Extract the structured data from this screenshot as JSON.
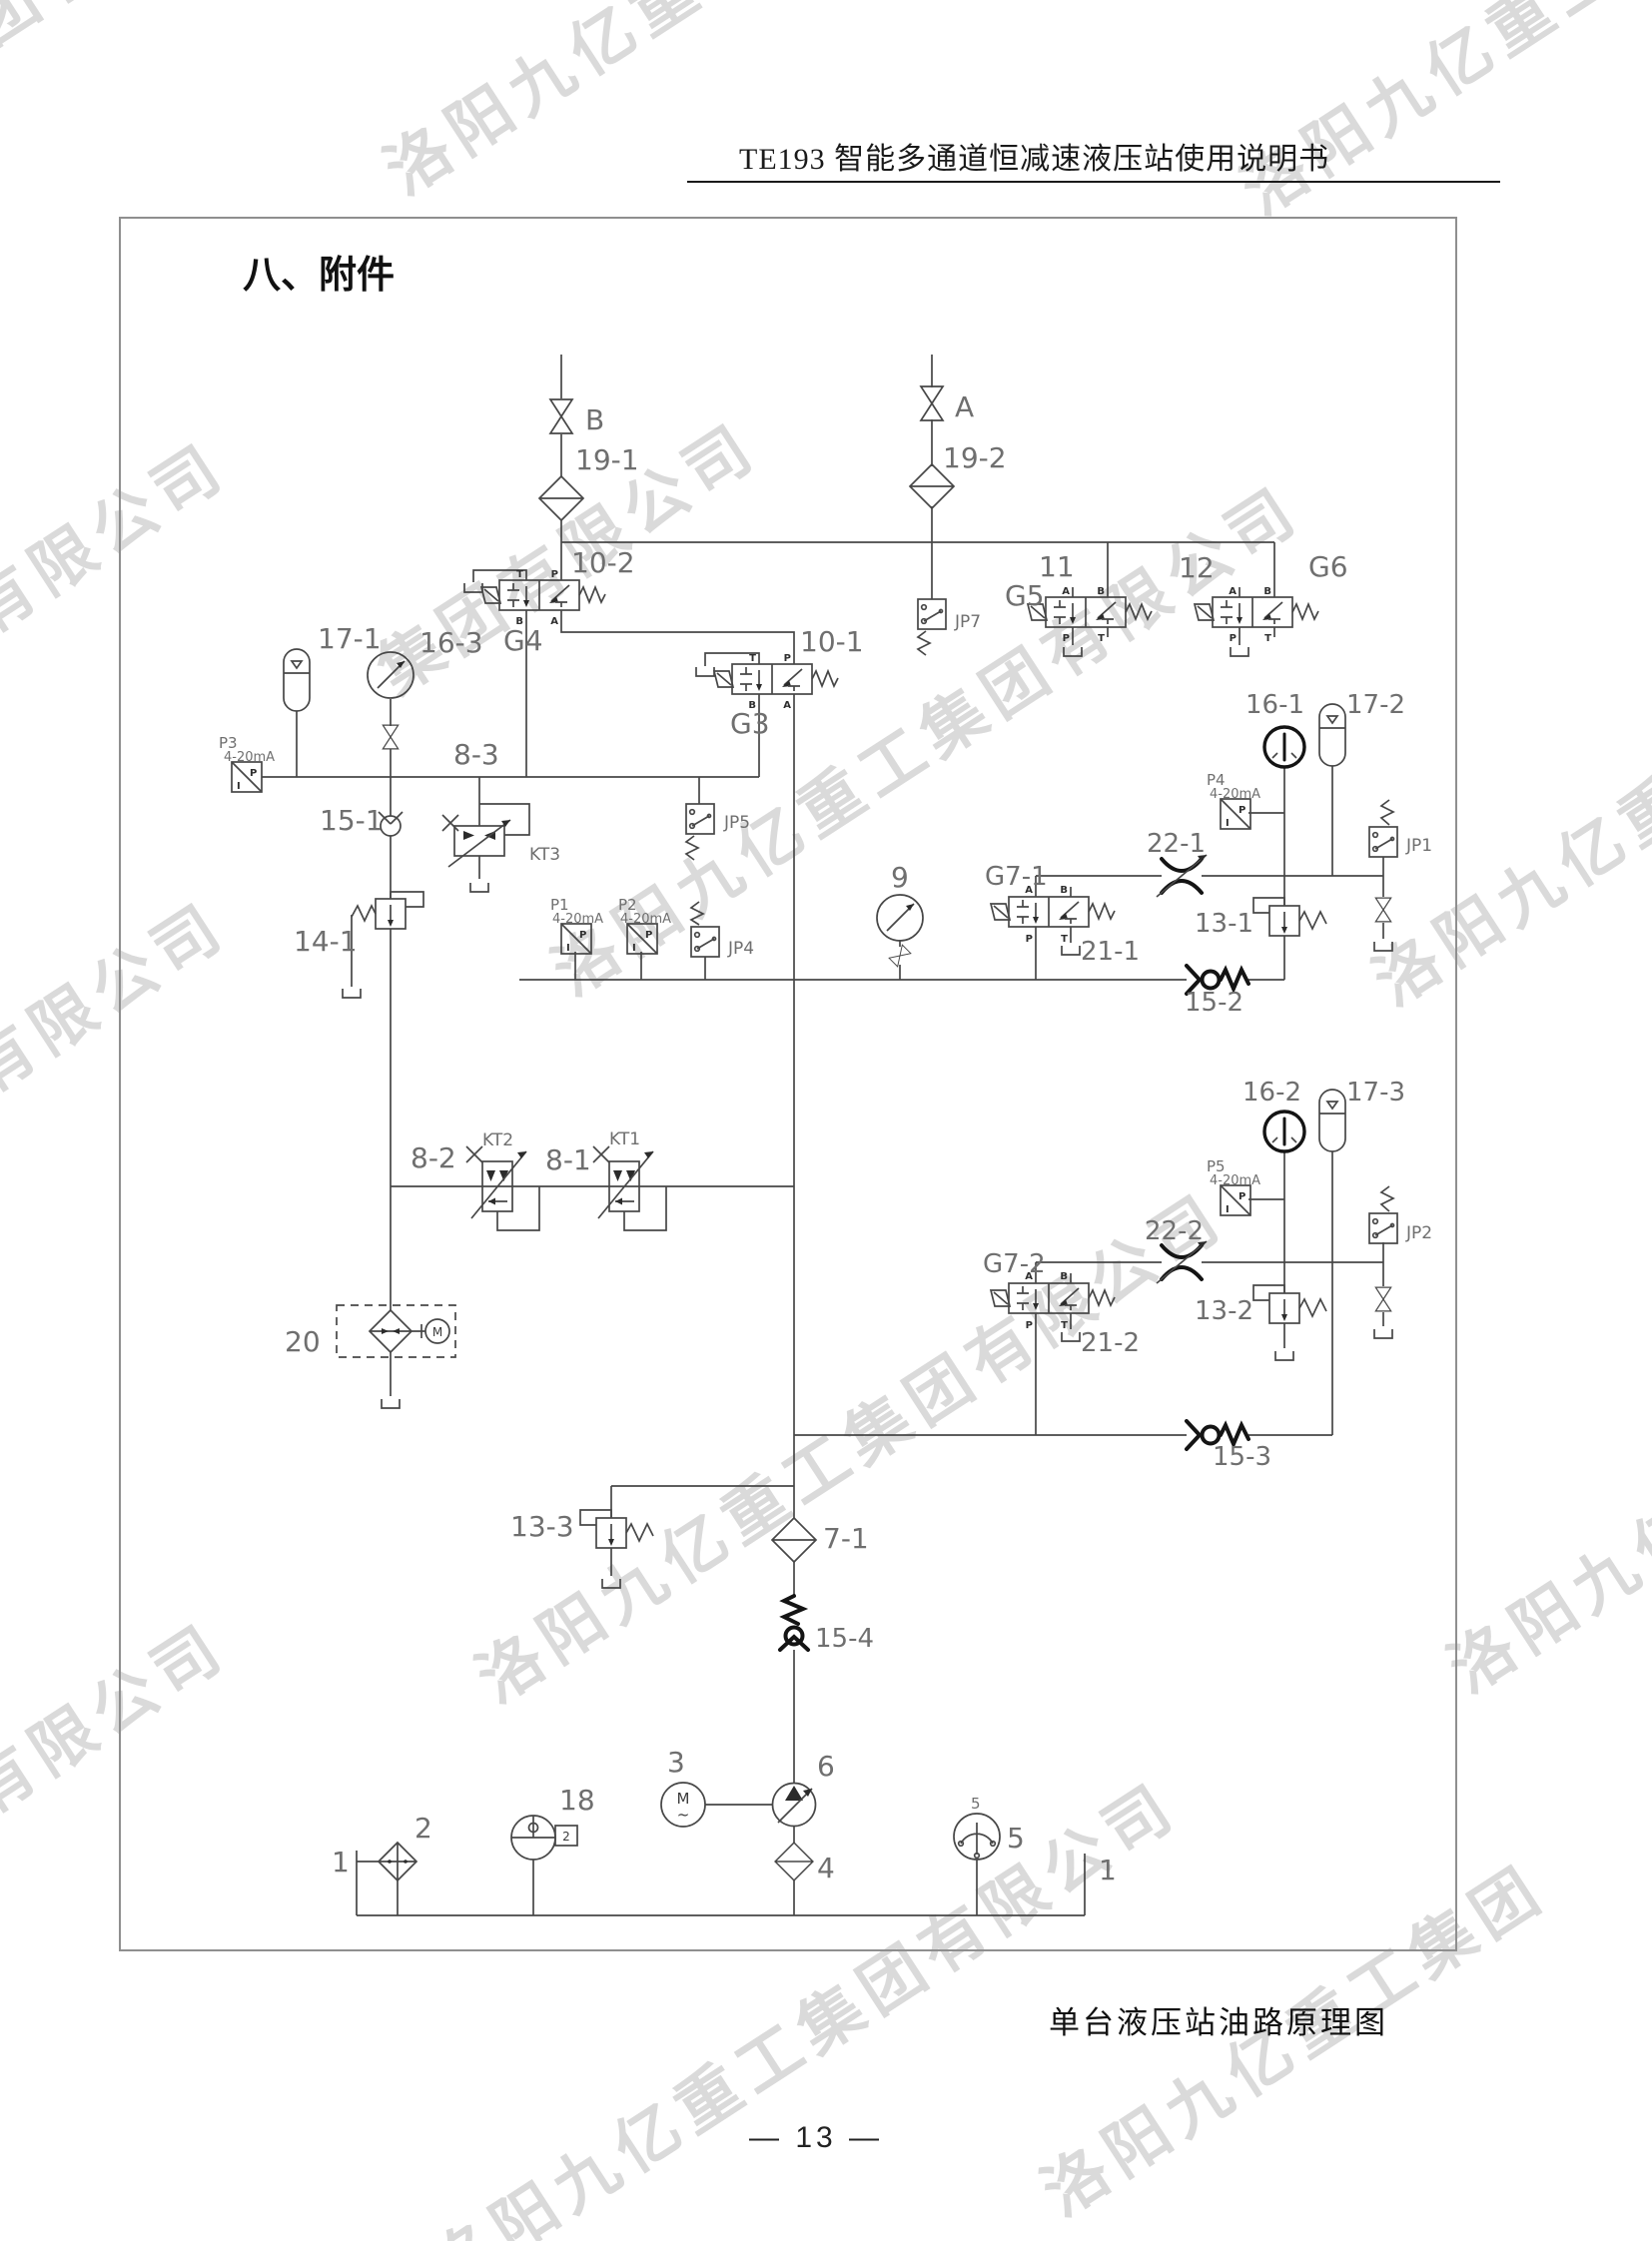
{
  "page": {
    "header_title": "TE193 智能多通道恒减速液压站使用说明书",
    "section_title": "八、附件",
    "page_number": "— 13 —"
  },
  "watermark": {
    "full": "洛阳九亿重工集团有限公司",
    "seg_a": "集团有限公司",
    "seg_b": "洛阳九亿重工",
    "seg_c": "洛阳九亿重工集团"
  },
  "diagram": {
    "caption": "单台液压站油路原理图",
    "labels": {
      "b": "B",
      "a": "A",
      "f19_1": "19-1",
      "f19_2": "19-2",
      "v10_2": "10-2",
      "g4": "G4",
      "v10_1": "10-1",
      "g3": "G3",
      "n11": "11",
      "g5": "G5",
      "n12": "12",
      "g6": "G6",
      "jp7": "JP7",
      "acc17_1": "17-1",
      "g16_3": "16-3",
      "p3": "P3",
      "ma": "4-20mA",
      "r8_3": "8-3",
      "c15_1": "15-1",
      "kt3": "KT3",
      "v14_1": "14-1",
      "p1": "P1",
      "p2": "P2",
      "jp4": "JP4",
      "jp5": "JP5",
      "n9": "9",
      "g7_1": "G7-1",
      "n21_1": "21-1",
      "n22_1": "22-1",
      "g16_1": "16-1",
      "acc17_2": "17-2",
      "p4": "P4",
      "jp1": "JP1",
      "v13_1": "13-1",
      "c15_2": "15-2",
      "g16_2": "16-2",
      "acc17_3": "17-3",
      "p5": "P5",
      "jp2": "JP2",
      "n22_2": "22-2",
      "g7_2": "G7-2",
      "n21_2": "21-2",
      "v13_2": "13-2",
      "c15_3": "15-3",
      "r8_2": "8-2",
      "kt2": "KT2",
      "r8_1": "8-1",
      "kt1": "KT1",
      "n20": "20",
      "v13_3": "13-3",
      "f7_1": "7-1",
      "c15_4": "15-4",
      "n1": "1",
      "n2": "2",
      "n18": "18",
      "n3": "3",
      "n6": "6",
      "n4": "4",
      "n5": "5"
    },
    "ports": {
      "T": "T",
      "P": "P",
      "A": "A",
      "B": "B",
      "I": "I",
      "M": "M",
      "AC": "~",
      "N2": "2"
    }
  }
}
